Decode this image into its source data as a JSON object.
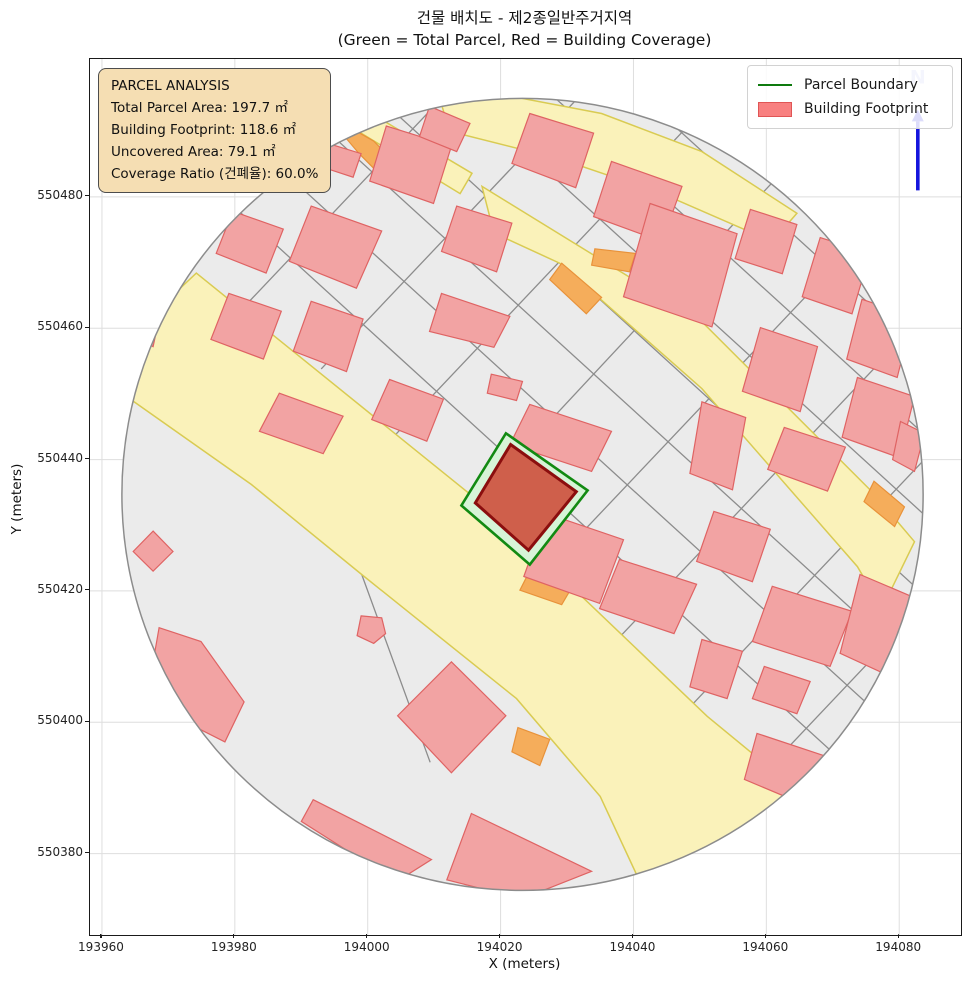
{
  "title": "건물 배치도 - 제2종일반주거지역",
  "subtitle": "(Green = Total Parcel, Red = Building Coverage)",
  "info_box": {
    "heading": "PARCEL ANALYSIS",
    "lines": [
      "Total Parcel Area: 197.7 ㎡",
      "Building Footprint: 118.6 ㎡",
      "Uncovered Area: 79.1 ㎡",
      "Coverage Ratio (건폐율): 60.0%"
    ]
  },
  "legend": {
    "items": [
      {
        "label": "Parcel Boundary",
        "type": "line",
        "color": "#0e7a0e"
      },
      {
        "label": "Building Footprint",
        "type": "patch",
        "color": "#f88080"
      }
    ]
  },
  "axes": {
    "xlabel": "X (meters)",
    "ylabel": "Y (meters)",
    "x_ticks": [
      193960,
      193980,
      194000,
      194020,
      194040,
      194060,
      194080
    ],
    "y_ticks": [
      550380,
      550400,
      550420,
      550440,
      550460,
      550480
    ],
    "x_range": [
      193958.2,
      194089.3
    ],
    "y_range": [
      550367.6,
      550501.0
    ]
  },
  "north": {
    "label": "N"
  },
  "colors": {
    "parcel_base": "#ebebeb",
    "parcel_line": "#8c8c8c",
    "road_fill": "#faf2ba",
    "road_stroke": "#d9cb52",
    "orange_fill": "#f5ad5b",
    "orange_stroke": "#e8923a",
    "building_fill": "#f2a3a3",
    "building_stroke": "#df6363",
    "boundary_stroke": "#8c8c8c",
    "parcel_highlight_fill": "#d7f4d7",
    "parcel_highlight_stroke": "#128a12",
    "central_building_fill": "#cf5f4b",
    "central_building_stroke": "#8b0e0e",
    "grid": "#dedede",
    "north_arrow": "#1515dd",
    "north_label": "#b3baf2",
    "infobox_bg": "#f5deb3"
  },
  "chart_data": {
    "type": "map",
    "x_range": [
      193958.2,
      194089.3
    ],
    "y_range": [
      550367.6,
      550501.0
    ],
    "buffer_circle": {
      "cx": 194023.3,
      "cy": 550434.7,
      "r": 60.3
    },
    "parcel_boundary": [
      [
        194020.8,
        550444.0
      ],
      [
        194033.1,
        550435.3
      ],
      [
        194024.4,
        550424.0
      ],
      [
        194014.1,
        550433.0
      ]
    ],
    "building_footprint": [
      [
        194021.5,
        550442.3
      ],
      [
        194031.4,
        550435.1
      ],
      [
        194024.2,
        550426.2
      ],
      [
        194016.2,
        550433.4
      ]
    ],
    "roads": [
      [
        [
          193974.2,
          550468.4
        ],
        [
          194016.4,
          550433.9
        ],
        [
          194027.0,
          550424.2
        ],
        [
          194051.1,
          550400.9
        ],
        [
          194061.2,
          550392.5
        ],
        [
          194063.9,
          550384.1
        ],
        [
          194057.1,
          550371.2
        ],
        [
          194041.3,
          550375.0
        ],
        [
          194035.0,
          550388.7
        ],
        [
          194022.4,
          550403.6
        ],
        [
          193999.1,
          550422.5
        ],
        [
          193982.5,
          550436.2
        ],
        [
          193962.6,
          550450.4
        ],
        [
          193963.3,
          550458.0
        ]
      ],
      [
        [
          193998.7,
          550493.8
        ],
        [
          194015.7,
          550483.6
        ],
        [
          194013.9,
          550480.5
        ],
        [
          193996.6,
          550491.2
        ]
      ],
      [
        [
          194011.1,
          550494.1
        ],
        [
          194021.7,
          550495.3
        ],
        [
          194035.2,
          550492.7
        ],
        [
          194050.3,
          550486.9
        ],
        [
          194064.6,
          550477.5
        ],
        [
          194060.9,
          550473.2
        ],
        [
          194044.3,
          550480.5
        ],
        [
          194029.2,
          550485.7
        ],
        [
          194012.3,
          550490.0
        ]
      ],
      [
        [
          194017.2,
          550481.6
        ],
        [
          194050.3,
          550461.0
        ],
        [
          194075.9,
          550435.1
        ],
        [
          194082.3,
          550427.5
        ],
        [
          194077.4,
          550417.3
        ],
        [
          194073.7,
          550423.7
        ],
        [
          194050.3,
          550450.8
        ],
        [
          194028.9,
          550469.9
        ],
        [
          194019.0,
          550474.5
        ]
      ]
    ],
    "orange_strips": [
      [
        [
          194024.2,
          550422.7
        ],
        [
          194031.0,
          550421.0
        ],
        [
          194029.2,
          550417.9
        ],
        [
          194022.9,
          550420.1
        ]
      ],
      [
        [
          193997.8,
          550490.3
        ],
        [
          194000.9,
          550488.5
        ],
        [
          194005.1,
          550484.2
        ],
        [
          194002.8,
          550482.4
        ],
        [
          193998.7,
          550486.6
        ],
        [
          193996.6,
          550489.1
        ]
      ],
      [
        [
          194029.2,
          550469.9
        ],
        [
          194035.2,
          550464.7
        ],
        [
          194032.9,
          550462.2
        ],
        [
          194027.4,
          550467.4
        ]
      ],
      [
        [
          194034.2,
          550472.1
        ],
        [
          194040.3,
          550471.4
        ],
        [
          194039.4,
          550468.6
        ],
        [
          194033.7,
          550469.6
        ]
      ],
      [
        [
          194022.6,
          550399.2
        ],
        [
          194027.4,
          550397.4
        ],
        [
          194025.9,
          550393.4
        ],
        [
          194021.7,
          550395.5
        ]
      ],
      [
        [
          194076.2,
          550436.7
        ],
        [
          194080.8,
          550432.8
        ],
        [
          194079.3,
          550429.8
        ],
        [
          194074.7,
          550433.6
        ]
      ]
    ],
    "buildings": [
      [
        [
          193994.5,
          550488.0
        ],
        [
          193999.0,
          550486.6
        ],
        [
          193997.8,
          550483.0
        ],
        [
          193993.3,
          550484.5
        ]
      ],
      [
        [
          194002.8,
          550490.8
        ],
        [
          194012.6,
          550487.7
        ],
        [
          194009.9,
          550479.0
        ],
        [
          194000.3,
          550482.4
        ]
      ],
      [
        [
          194024.4,
          550492.7
        ],
        [
          194034.0,
          550489.7
        ],
        [
          194031.3,
          550481.4
        ],
        [
          194021.7,
          550485.1
        ]
      ],
      [
        [
          194036.7,
          550485.4
        ],
        [
          194047.3,
          550481.6
        ],
        [
          194044.3,
          550473.2
        ],
        [
          194034.0,
          550477.0
        ]
      ],
      [
        [
          194009.3,
          550493.8
        ],
        [
          194015.4,
          550491.2
        ],
        [
          194013.4,
          550486.9
        ],
        [
          194007.8,
          550489.2
        ]
      ],
      [
        [
          193979.7,
          550477.8
        ],
        [
          193987.3,
          550475.1
        ],
        [
          193984.7,
          550468.4
        ],
        [
          193977.2,
          550471.4
        ]
      ],
      [
        [
          193991.5,
          550478.6
        ],
        [
          194002.1,
          550474.8
        ],
        [
          193998.3,
          550466.1
        ],
        [
          193988.2,
          550470.2
        ]
      ],
      [
        [
          194013.4,
          550478.6
        ],
        [
          194021.7,
          550476.0
        ],
        [
          194019.4,
          550468.6
        ],
        [
          194011.1,
          550471.7
        ]
      ],
      [
        [
          193979.1,
          550465.3
        ],
        [
          193987.0,
          550462.6
        ],
        [
          193984.3,
          550455.3
        ],
        [
          193976.4,
          550458.3
        ]
      ],
      [
        [
          193991.5,
          550464.1
        ],
        [
          193999.3,
          550461.4
        ],
        [
          193996.8,
          550453.4
        ],
        [
          193988.8,
          550456.5
        ]
      ],
      [
        [
          194011.1,
          550465.3
        ],
        [
          194021.4,
          550461.8
        ],
        [
          194019.0,
          550457.1
        ],
        [
          194009.3,
          550459.5
        ]
      ],
      [
        [
          193986.7,
          550450.1
        ],
        [
          193996.3,
          550446.6
        ],
        [
          193993.3,
          550440.9
        ],
        [
          193983.7,
          550444.3
        ]
      ],
      [
        [
          194003.3,
          550452.2
        ],
        [
          194011.4,
          550449.2
        ],
        [
          194008.9,
          550442.8
        ],
        [
          194000.6,
          550446.1
        ]
      ],
      [
        [
          194018.6,
          550453.0
        ],
        [
          194023.3,
          550451.9
        ],
        [
          194022.4,
          550449.0
        ],
        [
          194018.0,
          550450.1
        ]
      ],
      [
        [
          194024.4,
          550448.4
        ],
        [
          194036.7,
          550444.3
        ],
        [
          194033.7,
          550438.2
        ],
        [
          194021.4,
          550442.3
        ]
      ],
      [
        [
          194026.9,
          550431.8
        ],
        [
          194038.5,
          550427.8
        ],
        [
          194034.9,
          550418.1
        ],
        [
          194023.5,
          550422.2
        ]
      ],
      [
        [
          194037.9,
          550424.8
        ],
        [
          194049.5,
          550421.0
        ],
        [
          194046.1,
          550413.5
        ],
        [
          194034.9,
          550417.3
        ]
      ],
      [
        [
          194052.1,
          550432.1
        ],
        [
          194060.6,
          550429.4
        ],
        [
          194057.9,
          550421.4
        ],
        [
          194049.5,
          550424.5
        ]
      ],
      [
        [
          194042.5,
          550479.0
        ],
        [
          194055.6,
          550474.4
        ],
        [
          194051.8,
          550460.2
        ],
        [
          194038.5,
          550464.8
        ]
      ],
      [
        [
          194057.6,
          550478.1
        ],
        [
          194064.6,
          550475.8
        ],
        [
          194062.4,
          550468.3
        ],
        [
          194055.3,
          550470.6
        ]
      ],
      [
        [
          194068.1,
          550473.8
        ],
        [
          194075.6,
          550471.4
        ],
        [
          194072.9,
          550462.2
        ],
        [
          194065.4,
          550464.8
        ]
      ],
      [
        [
          194074.4,
          550464.4
        ],
        [
          194082.0,
          550461.8
        ],
        [
          194079.7,
          550452.5
        ],
        [
          194072.1,
          550455.3
        ]
      ],
      [
        [
          194073.7,
          550452.5
        ],
        [
          194082.3,
          550449.6
        ],
        [
          194080.0,
          550440.3
        ],
        [
          194071.4,
          550443.4
        ]
      ],
      [
        [
          194059.1,
          550460.1
        ],
        [
          194067.7,
          550457.2
        ],
        [
          194065.1,
          550447.3
        ],
        [
          194056.4,
          550450.4
        ]
      ],
      [
        [
          194050.3,
          550448.8
        ],
        [
          194056.9,
          550446.4
        ],
        [
          194054.9,
          550435.4
        ],
        [
          194048.5,
          550437.9
        ]
      ],
      [
        [
          194062.7,
          550444.9
        ],
        [
          194071.9,
          550441.9
        ],
        [
          194069.2,
          550435.2
        ],
        [
          194060.2,
          550438.5
        ]
      ],
      [
        [
          194080.2,
          550445.8
        ],
        [
          194083.8,
          550444.0
        ],
        [
          194082.3,
          550438.2
        ],
        [
          194079.0,
          550440.0
        ]
      ],
      [
        [
          194060.9,
          550420.7
        ],
        [
          194072.9,
          550416.9
        ],
        [
          194069.6,
          550408.5
        ],
        [
          194057.9,
          550412.3
        ]
      ],
      [
        [
          194059.7,
          550408.5
        ],
        [
          194066.6,
          550406.2
        ],
        [
          194064.6,
          550401.3
        ],
        [
          194057.9,
          550403.6
        ]
      ],
      [
        [
          194050.3,
          550412.6
        ],
        [
          194056.4,
          550410.8
        ],
        [
          194054.1,
          550403.6
        ],
        [
          194048.5,
          550405.4
        ]
      ],
      [
        [
          194074.1,
          550422.5
        ],
        [
          194082.0,
          550419.1
        ],
        [
          194078.2,
          550407.2
        ],
        [
          194071.1,
          550410.5
        ]
      ],
      [
        [
          194058.6,
          550398.3
        ],
        [
          194069.6,
          550394.6
        ],
        [
          194065.4,
          550387.6
        ],
        [
          194056.7,
          550391.3
        ]
      ],
      [
        [
          193967.7,
          550429.1
        ],
        [
          193970.7,
          550426.0
        ],
        [
          193967.7,
          550423.0
        ],
        [
          193964.7,
          550426.0
        ]
      ],
      [
        [
          193968.6,
          550414.4
        ],
        [
          193974.9,
          550412.3
        ],
        [
          193981.4,
          550403.1
        ],
        [
          193978.5,
          550397.0
        ],
        [
          193970.1,
          550401.3
        ],
        [
          193967.7,
          550409.2
        ]
      ],
      [
        [
          193999.0,
          550416.2
        ],
        [
          194002.1,
          550415.9
        ],
        [
          194002.7,
          550413.5
        ],
        [
          194000.9,
          550412.0
        ],
        [
          193998.4,
          550413.2
        ]
      ],
      [
        [
          194012.6,
          550409.2
        ],
        [
          194020.8,
          550401.0
        ],
        [
          194012.6,
          550392.3
        ],
        [
          194004.5,
          550401.0
        ]
      ],
      [
        [
          193991.8,
          550388.2
        ],
        [
          194009.6,
          550379.1
        ],
        [
          194004.3,
          550375.7
        ],
        [
          193990.0,
          550384.9
        ]
      ],
      [
        [
          194015.6,
          550386.1
        ],
        [
          194033.7,
          550377.3
        ],
        [
          194023.2,
          550373.1
        ],
        [
          194011.9,
          550376.0
        ]
      ],
      [
        [
          193965.9,
          550464.1
        ],
        [
          193968.9,
          550462.9
        ],
        [
          193967.7,
          550457.2
        ],
        [
          193964.8,
          550458.6
        ]
      ]
    ],
    "parcel_lines": [
      [
        [
          193955.7,
          550500.8
        ],
        [
          194088.0,
          550378.8
        ]
      ],
      [
        [
          193961.8,
          550507.4
        ],
        [
          194094.1,
          550385.4
        ]
      ],
      [
        [
          193967.9,
          550514.0
        ],
        [
          194100.2,
          550392.0
        ]
      ],
      [
        [
          193974.0,
          550520.6
        ],
        [
          194106.3,
          550398.6
        ]
      ],
      [
        [
          193980.1,
          550527.2
        ],
        [
          194112.4,
          550405.2
        ]
      ],
      [
        [
          193986.2,
          550533.8
        ],
        [
          194118.5,
          550411.8
        ]
      ],
      [
        [
          193992.3,
          550540.5
        ],
        [
          194124.6,
          550418.4
        ]
      ],
      [
        [
          193982.0,
          550463.9
        ],
        [
          194041.0,
          550526.9
        ]
      ],
      [
        [
          193993.0,
          550453.8
        ],
        [
          194052.0,
          550516.8
        ]
      ],
      [
        [
          194004.0,
          550443.6
        ],
        [
          194063.0,
          550506.6
        ]
      ],
      [
        [
          194015.0,
          550432.4
        ],
        [
          194074.0,
          550496.4
        ]
      ],
      [
        [
          194026.1,
          550422.3
        ],
        [
          194085.1,
          550485.3
        ]
      ],
      [
        [
          194037.1,
          550412.1
        ],
        [
          194096.1,
          550475.1
        ]
      ],
      [
        [
          194048.1,
          550401.9
        ],
        [
          194107.1,
          550464.9
        ]
      ],
      [
        [
          194059.2,
          550391.8
        ],
        [
          194118.2,
          550454.8
        ]
      ],
      [
        [
          193999.1,
          550422.5
        ],
        [
          194009.4,
          550393.9
        ]
      ]
    ],
    "north_marker": {
      "x": 194082.8,
      "line_y0": 550481.0,
      "line_y1": 550491.5,
      "head_y": 550493.3,
      "label_y": 550497.3
    }
  }
}
